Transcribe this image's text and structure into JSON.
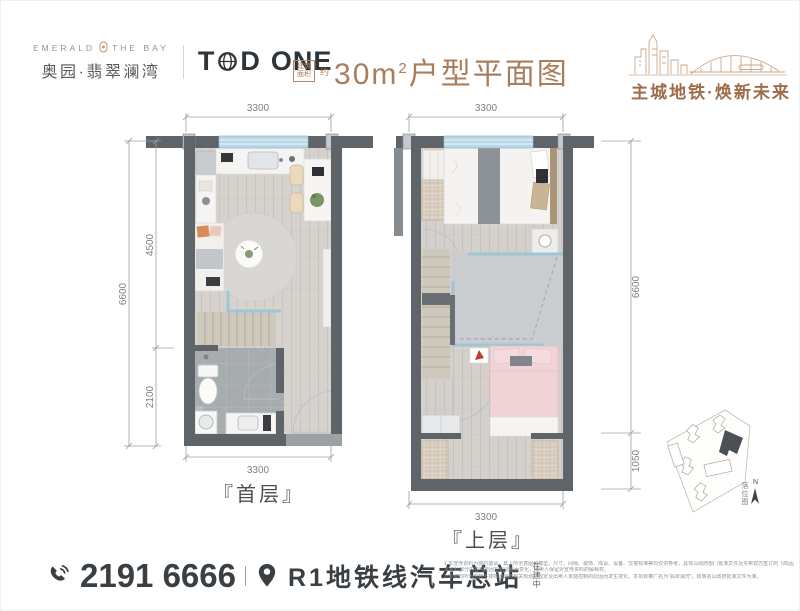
{
  "header": {
    "logo_en_left": "EMERALD",
    "logo_en_right": "THE BAY",
    "logo_cn": "奥园·翡翠澜湾",
    "brand_t": "T",
    "brand_d": "D",
    "brand_one": "ONE",
    "title_box_line1": "建筑",
    "title_box_line2": "面积",
    "title_approx": "约",
    "title_num": "30m",
    "title_sup": "2",
    "title_rest": "户型平面图",
    "tagline": "主城地铁·焕新未来"
  },
  "plans": [
    {
      "label": "『首层』",
      "dim_top": "3300",
      "dim_bottom": "3300",
      "dim_total": "6600",
      "dim_upper": "4500",
      "dim_lower": "2100"
    },
    {
      "label": "『上层』",
      "dim_top": "3300",
      "dim_bottom": "3300",
      "dim_total": "6600",
      "dim_lower": "1050"
    }
  ],
  "site_map": {
    "label": "落位图",
    "north": "N"
  },
  "footer": {
    "phone": "2191 6666",
    "location": "R1地铁线汽车总站",
    "location_note": "在建中",
    "disclaimer_lines": [
      "1.本宣传资料为要约邀请，其上所示意图和模型、尺寸、间隔、装饰、陈设、设备、交楼标准等均仅供参考，具体以政府部门批准文件及买卖双方签订的《商品房买卖合同》约定为准。",
      "本资料部分内容可能因规划调整而变化，出卖人保留对宣传资料的解释权。",
      "2.本资料所示内容不排除因政府相关规划、规定及出卖人未能控制的原因而发生变化。本项目推广名为“翡翠澜湾”，核准名以政府批准文件为准。"
    ]
  },
  "colors": {
    "brand_brown": "#a87e5e",
    "tagline_brown": "#9e6c48",
    "dark_text": "#3a3f44",
    "wall": "#5f6468",
    "window_blue": "#b9d8e6"
  }
}
